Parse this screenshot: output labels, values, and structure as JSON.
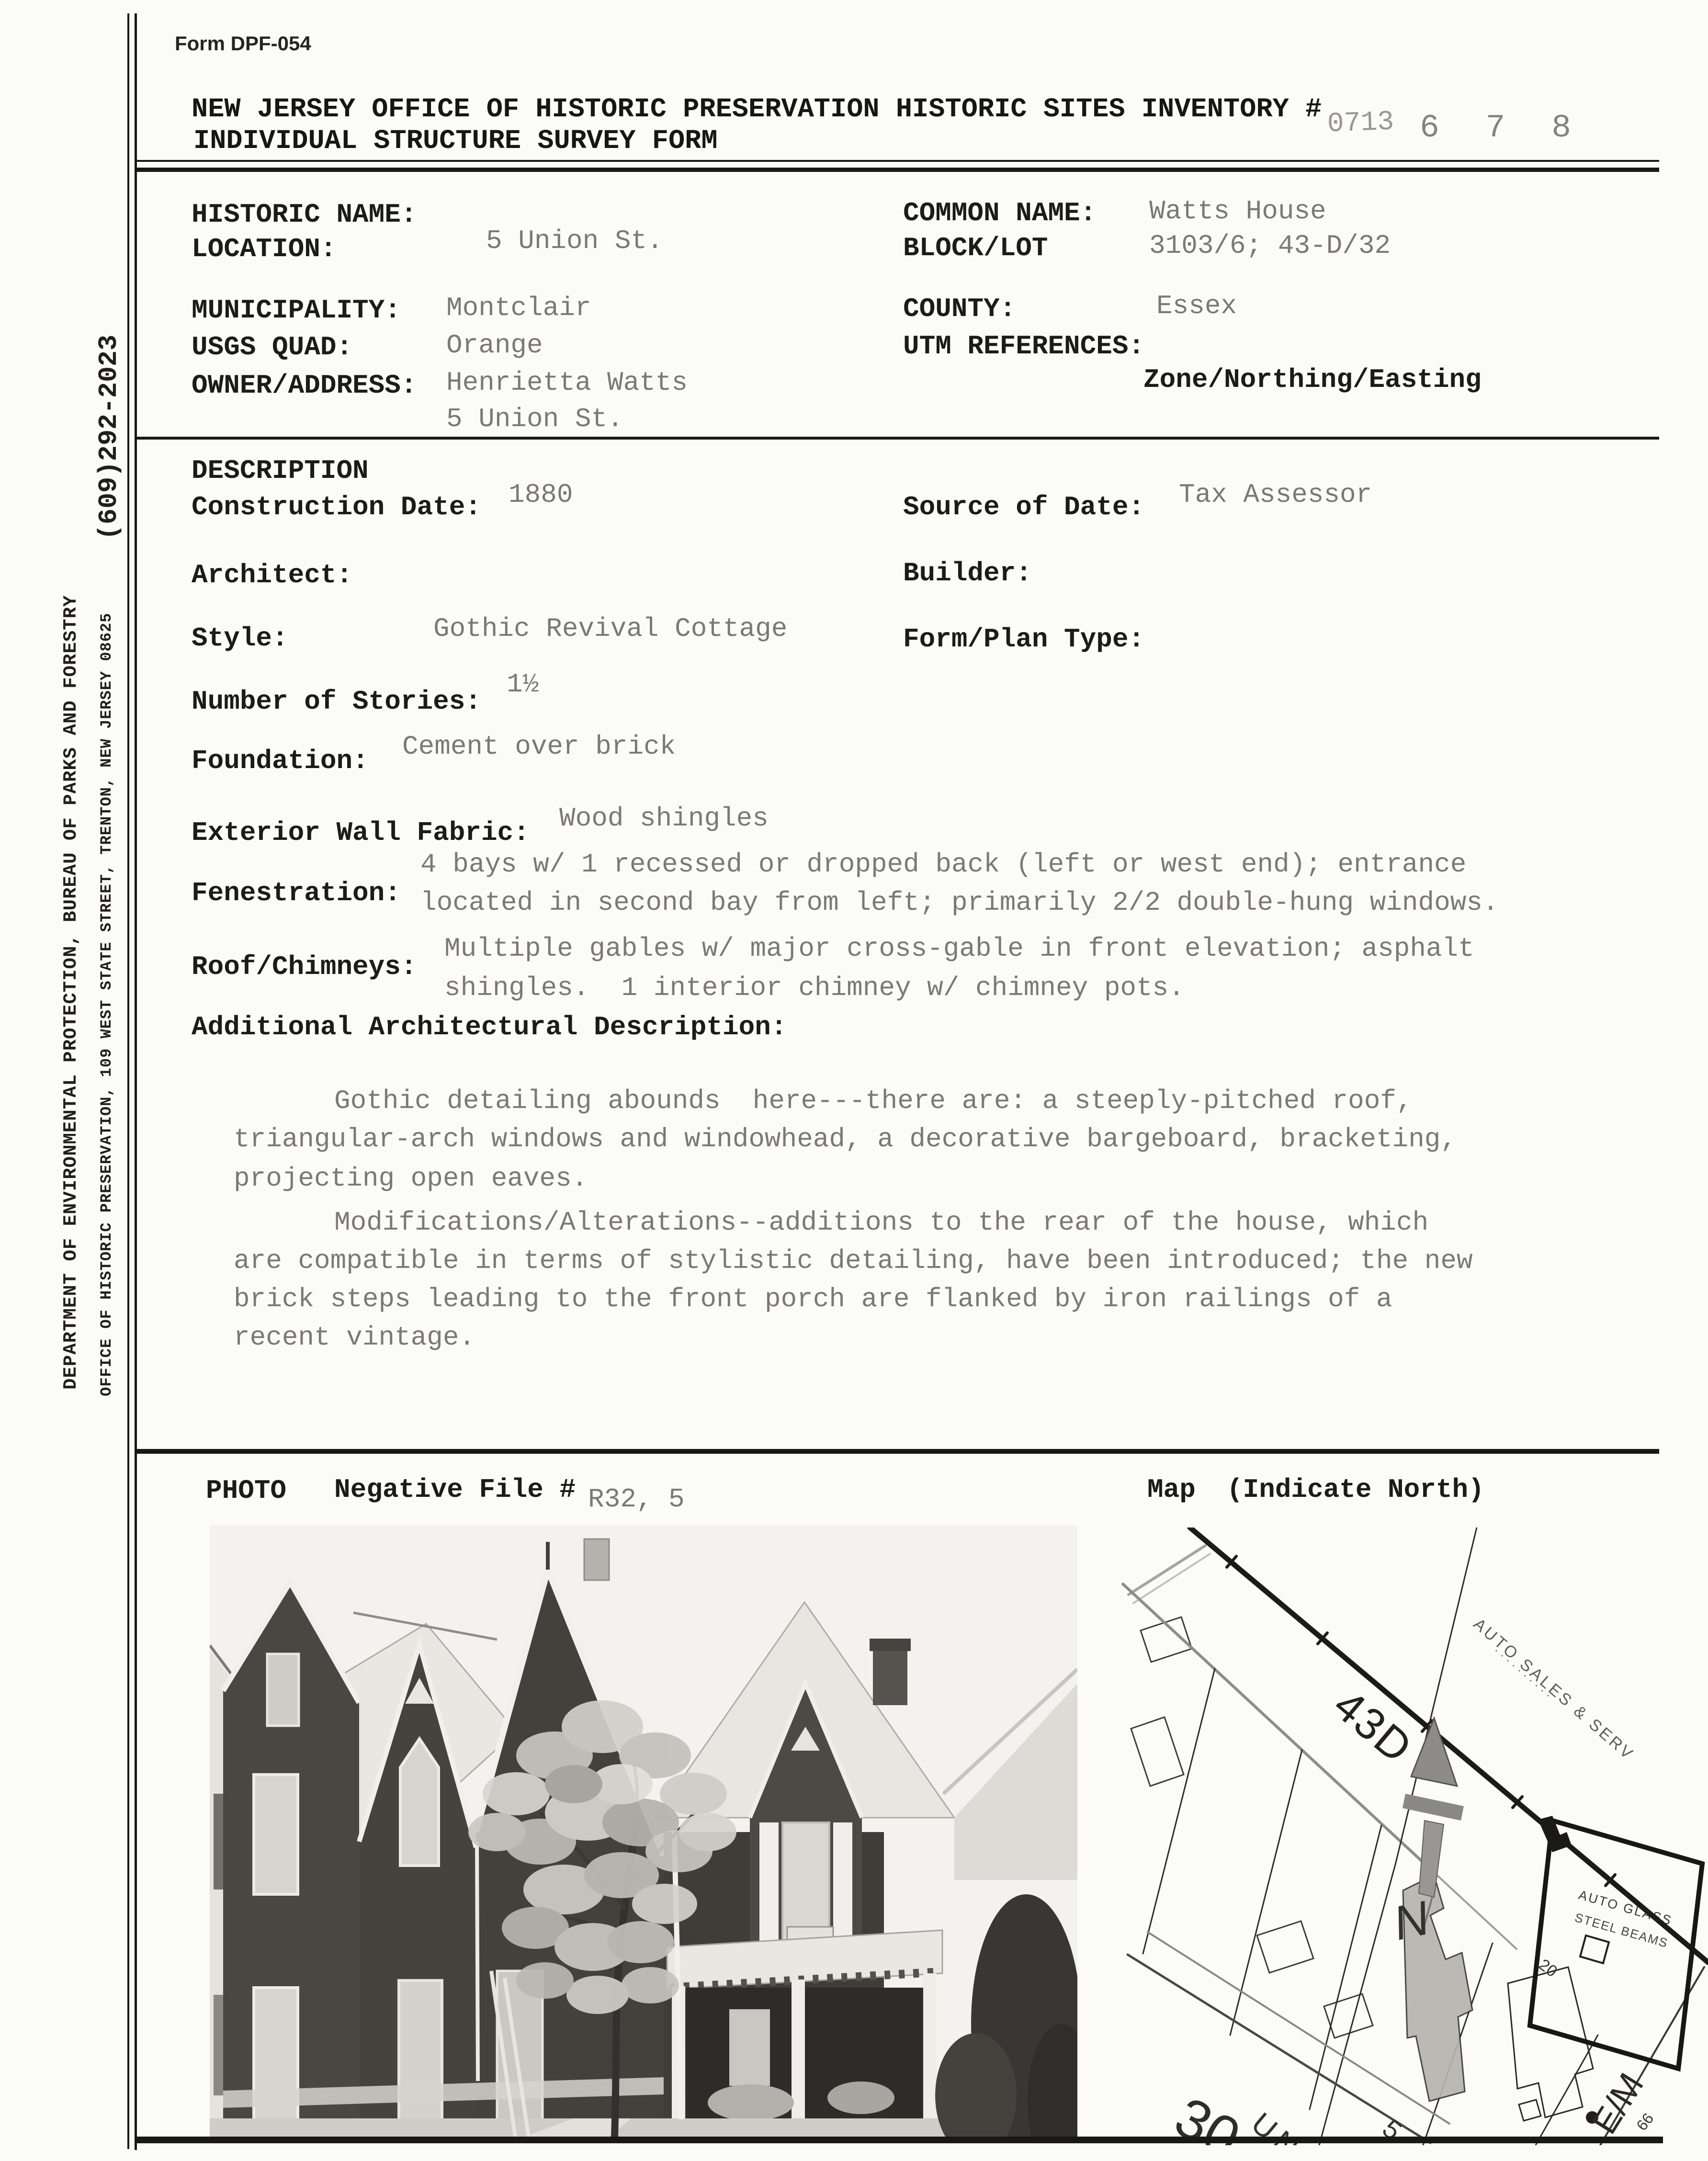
{
  "header": {
    "form_number": "Form DPF-054",
    "title_line1": "NEW JERSEY OFFICE OF HISTORIC PRESERVATION HISTORIC SITES INVENTORY #",
    "title_line2": "INDIVIDUAL STRUCTURE SURVEY FORM",
    "inventory_stamp_prefix": "0713",
    "inventory_stamp_suffix": "6 7 8"
  },
  "sidebar": {
    "phone": "(609)292-2023",
    "department": "DEPARTMENT OF ENVIRONMENTAL PROTECTION, BUREAU OF PARKS AND FORESTRY",
    "office": "OFFICE OF HISTORIC PRESERVATION, 109 WEST STATE STREET, TRENTON, NEW JERSEY 08625"
  },
  "identification": {
    "historic_name_label": "HISTORIC NAME:",
    "location_label": "LOCATION:",
    "location_value": "5 Union St.",
    "common_name_label": "COMMON NAME:",
    "common_name_value": "Watts House",
    "block_lot_label": "BLOCK/LOT",
    "block_lot_value": "3103/6; 43-D/32",
    "municipality_label": "MUNICIPALITY:",
    "municipality_value": "Montclair",
    "county_label": "COUNTY:",
    "county_value": "Essex",
    "usgs_quad_label": "USGS QUAD:",
    "usgs_quad_value": "Orange",
    "utm_label": "UTM REFERENCES:",
    "utm_value": "Zone/Northing/Easting",
    "owner_label": "OWNER/ADDRESS:",
    "owner_value_line1": "Henrietta Watts",
    "owner_value_line2": "5 Union St."
  },
  "description": {
    "section_label": "DESCRIPTION",
    "construction_date_label": "Construction Date:",
    "construction_date_value": "1880",
    "source_of_date_label": "Source of Date:",
    "source_of_date_value": "Tax Assessor",
    "architect_label": "Architect:",
    "builder_label": "Builder:",
    "style_label": "Style:",
    "style_value": "Gothic Revival Cottage",
    "form_plan_label": "Form/Plan Type:",
    "stories_label": "Number of Stories:",
    "stories_value": "1½",
    "foundation_label": "Foundation:",
    "foundation_value": "Cement over brick",
    "wall_fabric_label": "Exterior Wall Fabric:",
    "wall_fabric_value": "Wood shingles",
    "fenestration_label": "Fenestration:",
    "fenestration_lines": [
      "4 bays w/ 1 recessed or dropped back (left or west end); entrance",
      "located in second bay from left; primarily 2/2 double-hung windows."
    ],
    "roof_label": "Roof/Chimneys:",
    "roof_lines": [
      "Multiple gables w/ major cross-gable in front elevation; asphalt",
      "shingles.  1 interior chimney w/ chimney pots."
    ],
    "additional_label": "Additional Architectural Description:",
    "paragraph1_lines": [
      "Gothic detailing abounds  here---there are: a steeply-pitched roof,",
      "triangular-arch windows and windowhead, a decorative bargeboard, bracketing,",
      "projecting open eaves."
    ],
    "paragraph2_lines": [
      "Modifications/Alterations--additions to the rear of the house, which",
      "are compatible in terms of stylistic detailing, have been introduced; the new",
      "brick steps leading to the front porch are flanked by iron railings of a",
      "recent vintage."
    ]
  },
  "photo_section": {
    "photo_label": "PHOTO",
    "negative_file_label": "Negative File #",
    "negative_file_value": "R32, 5",
    "map_label": "Map",
    "map_note": "(Indicate North)"
  },
  "map": {
    "street_43d": "43D",
    "north": "N",
    "auto_sales": "AUTO SALES & SERV",
    "auto_glass_line1": "AUTO GLASS",
    "auto_glass_line2": "STEEL BEAMS",
    "union_street": "UNION",
    "block_30": "30",
    "lot_5": "5",
    "elm_street": "E/M",
    "lot_20": "20",
    "dim_66": "66"
  }
}
